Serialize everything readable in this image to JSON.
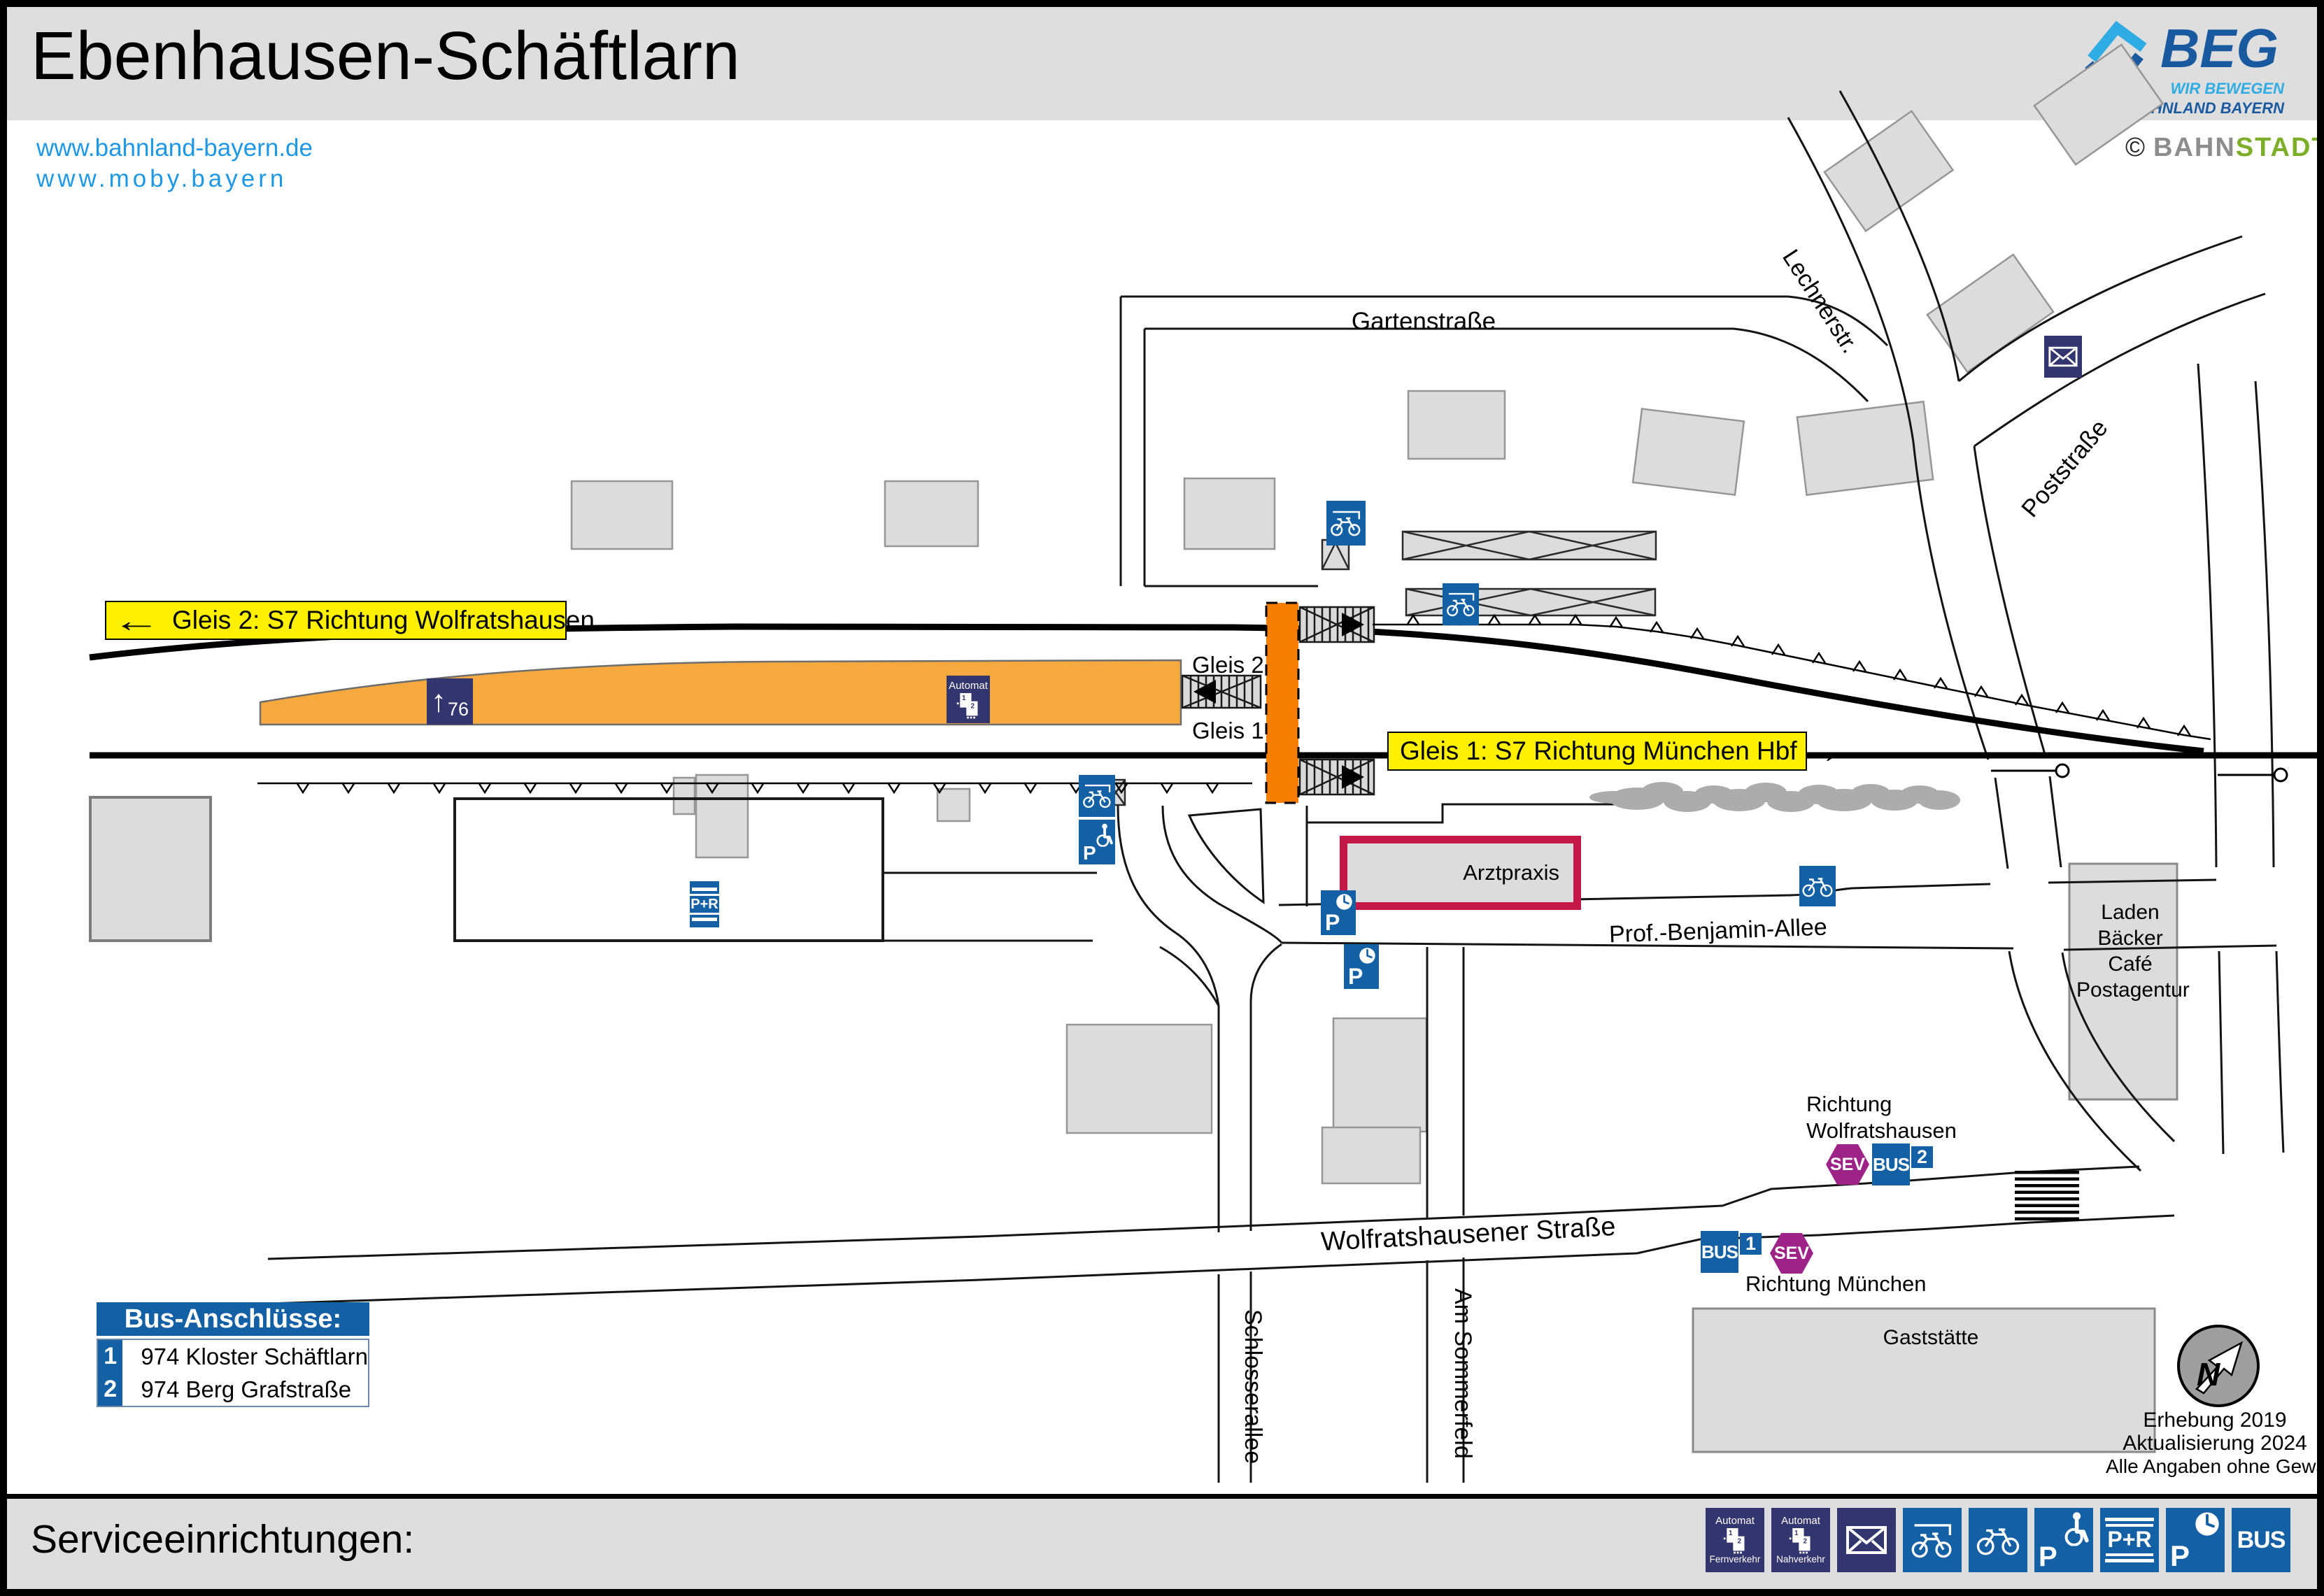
{
  "header": {
    "title": "Ebenhausen-Schäftlarn",
    "links": [
      "www.bahnland-bayern.de",
      "www.moby.bayern"
    ],
    "brand": {
      "name": "BEG",
      "tagline1": "WIR BEWEGEN",
      "tagline2": "DAS BAHNLAND BAYERN"
    },
    "credit": {
      "symbol": "©",
      "part1": "BAHN",
      "part2": "STADT"
    }
  },
  "map": {
    "direction_labels": {
      "gleis2": {
        "arrow": "←",
        "text": "Gleis 2: S7 Richtung Wolfratshausen"
      },
      "gleis1": {
        "text": "Gleis 1: S7 Richtung München Hbf",
        "arrow": "→"
      }
    },
    "tracks": {
      "gleis2": "Gleis 2",
      "gleis1": "Gleis 1"
    },
    "streets": {
      "gartenstrasse": "Gartenstraße",
      "lechnerstr": "Lechnerstr.",
      "poststrasse": "Poststraße",
      "benjamin_allee": "Prof.-Benjamin-Allee",
      "wolfratshausener": "Wolfratshausener Straße",
      "schlosserallee": "Schlosserallee",
      "am_sommerfeld": "Am Sommerfeld"
    },
    "buildings": {
      "arztpraxis": "Arztpraxis",
      "laden_lines": [
        "Laden",
        "Bäcker",
        "Café",
        "Postagentur"
      ],
      "gaststaette": "Gaststätte"
    },
    "bus": {
      "richtung_wolfratshausen": [
        "Richtung",
        "Wolfratshausen"
      ],
      "richtung_muenchen": "Richtung München",
      "bus_label": "BUS",
      "sev_label": "SEV",
      "stop1": "1",
      "stop2": "2"
    },
    "platform": {
      "height": "76",
      "arrow": "↑",
      "automat": "Automat"
    },
    "north": "N",
    "notes": [
      "Erhebung 2019",
      "Aktualisierung 2024",
      "Alle Angaben ohne Gewähr!"
    ]
  },
  "icons_text": {
    "p": "P",
    "pr": "P+R",
    "machine1": "1",
    "machine2": "2"
  },
  "legend": {
    "title": "Bus-Anschlüsse:",
    "items": [
      {
        "num": "1",
        "label": "974 Kloster Schäftlarn"
      },
      {
        "num": "2",
        "label": "974 Berg Grafstraße"
      }
    ]
  },
  "footer": {
    "title": "Serviceeinrichtungen:",
    "icons": [
      {
        "name": "ticket-machine-longdistance-icon",
        "top": "Automat",
        "bottom": "Fernverkehr"
      },
      {
        "name": "ticket-machine-local-icon",
        "top": "Automat",
        "bottom": "Nahverkehr"
      },
      {
        "name": "mailbox-icon"
      },
      {
        "name": "covered-bike-parking-icon"
      },
      {
        "name": "bike-parking-icon"
      },
      {
        "name": "accessible-parking-icon",
        "letter": "P"
      },
      {
        "name": "park-and-ride-icon",
        "label": "P+R"
      },
      {
        "name": "short-term-parking-icon",
        "letter": "P"
      },
      {
        "name": "bus-icon",
        "label": "BUS"
      }
    ]
  },
  "colors": {
    "header_gray": "#DEDEDE",
    "link_blue": "#1E98E4",
    "beg_dark_blue": "#19599F",
    "beg_light_blue": "#2FACE3",
    "bahn_gray": "#8D8D8D",
    "stadt_green": "#7CAE27",
    "icon_blue": "#1460A5",
    "icon_navy": "#32356E",
    "sev_purple": "#9E2387",
    "platform_orange": "#F6A93F",
    "crossing_orange": "#F57E00",
    "label_yellow": "#FFF000",
    "arztpraxis_red": "#C31848"
  }
}
